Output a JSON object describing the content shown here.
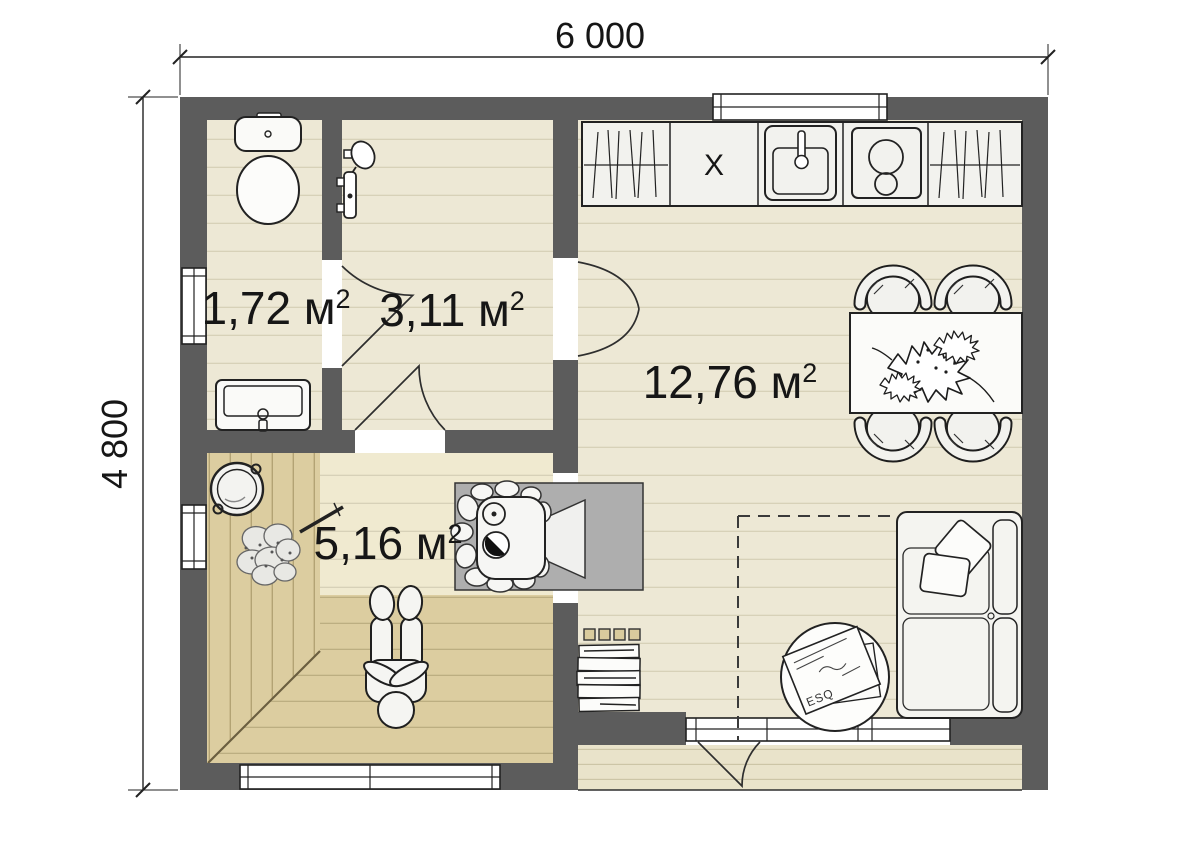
{
  "plan": {
    "title": "sauna-house-floor-plan",
    "dimensions": {
      "width": "6 000",
      "height": "4 800"
    },
    "rooms": {
      "wc": {
        "label": "1,72 м",
        "sup": "2"
      },
      "shower": {
        "label": "3,11 м",
        "sup": "2"
      },
      "living": {
        "label": "12,76 м",
        "sup": "2"
      },
      "sauna": {
        "label": "5,16 м",
        "sup": "2"
      }
    },
    "kitchen": {
      "cabinet_label": "X"
    },
    "rug": {
      "magazine_title": "ESQ"
    },
    "colors": {
      "wall": "#5C5C5C",
      "floor": "#EDE8D5",
      "sauna_wood": "#DCCDA0",
      "sauna_floor": "#F0EAD0",
      "terrace": "#E9E3CA",
      "hearth": "#AEAEAE"
    },
    "fixtures": [
      "toilet",
      "wash-basin",
      "shower-mixer",
      "kitchen-counter",
      "kitchen-sink",
      "cooktop",
      "drying-cabinets",
      "dining-table",
      "chairs",
      "plant",
      "sofa",
      "pillows",
      "sauna-stove",
      "stove-hearth",
      "bucket",
      "sauna-whisk",
      "person",
      "firewood-stack",
      "rug",
      "magazines"
    ]
  }
}
